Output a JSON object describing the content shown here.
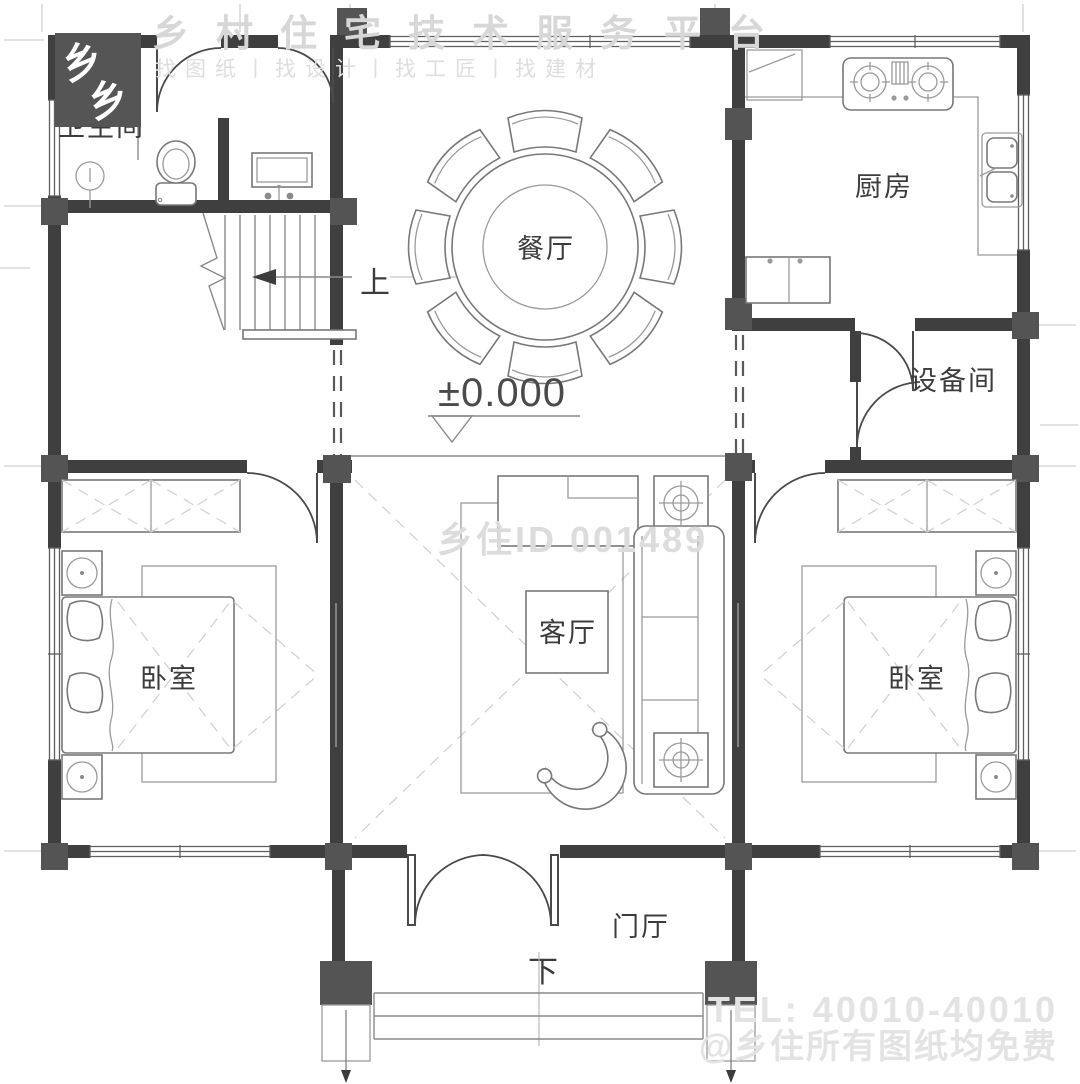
{
  "watermarks": {
    "platform_name": "乡村住宅技术服务平台",
    "platform_tagline": "找图纸丨找设计丨找工匠丨找建材",
    "logo_glyph": "乡",
    "center_id": "乡住ID 001489",
    "tel": "TEL: 40010-40010",
    "free_notice": "@乡住所有图纸均免费"
  },
  "rooms": {
    "bathroom": "卫生间",
    "kitchen": "厨房",
    "dining": "餐厅",
    "equipment": "设备间",
    "living": "客厅",
    "bedroom_left": "卧室",
    "bedroom_right": "卧室",
    "foyer": "门厅"
  },
  "annotations": {
    "elevation": "±0.000",
    "stairs_up": "上",
    "steps_down": "下"
  },
  "colors": {
    "wall": "#3f3f3f",
    "column": "#545454",
    "furniture_line": "#787878",
    "label_text": "#3c3c3c",
    "watermark": "#d9d9d9"
  }
}
